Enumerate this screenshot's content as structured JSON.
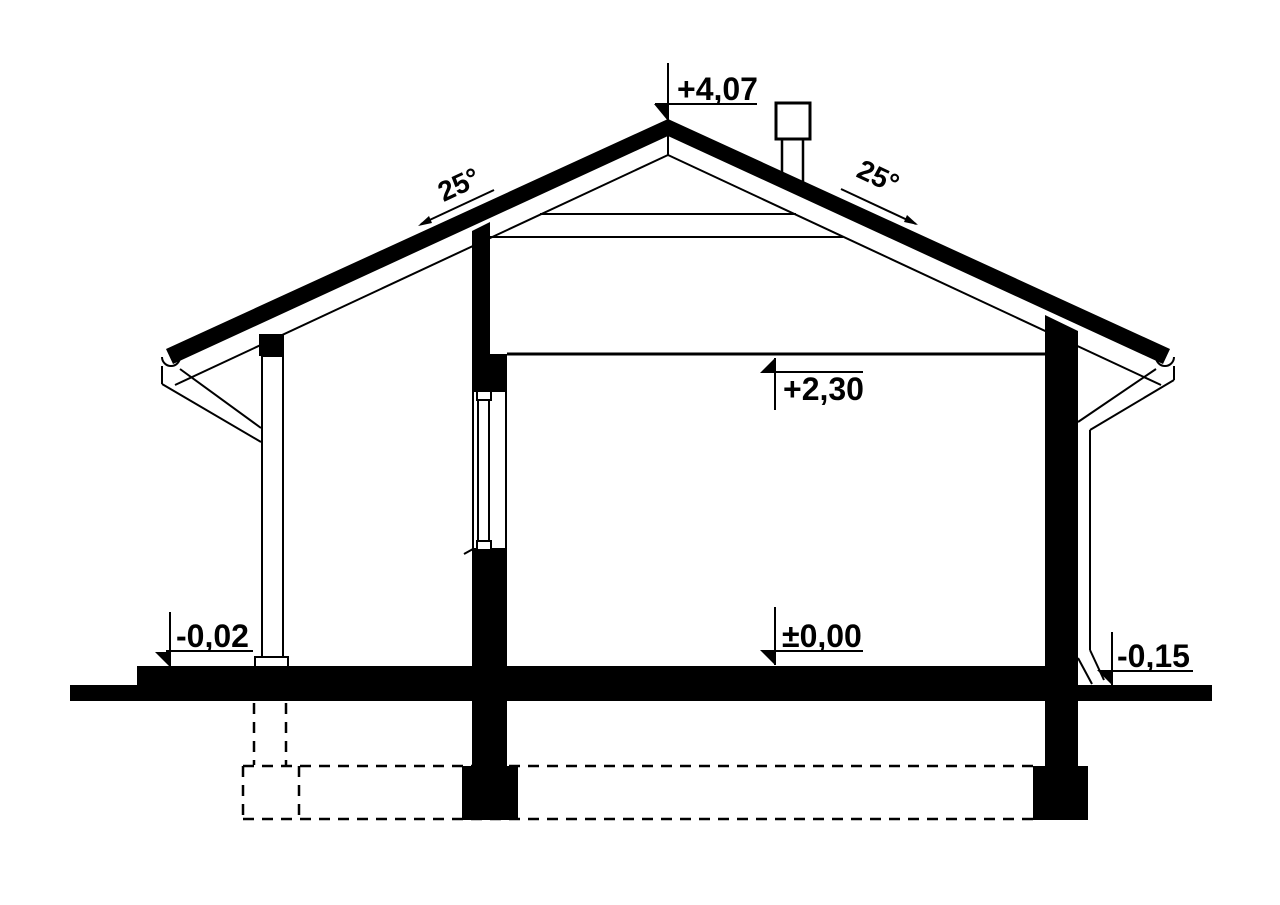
{
  "page": {
    "background": "#ffffff",
    "ink": "#000000"
  },
  "drawing": {
    "type": "architectural-house-cross-section",
    "roof": {
      "left_angle": "25°",
      "right_angle": "25°"
    },
    "elevations": {
      "ridge": "+4,07",
      "ceiling": "+2,30",
      "floor": "±0,00",
      "porch_slab": "-0,02",
      "exterior_grade": "-0,15"
    }
  }
}
